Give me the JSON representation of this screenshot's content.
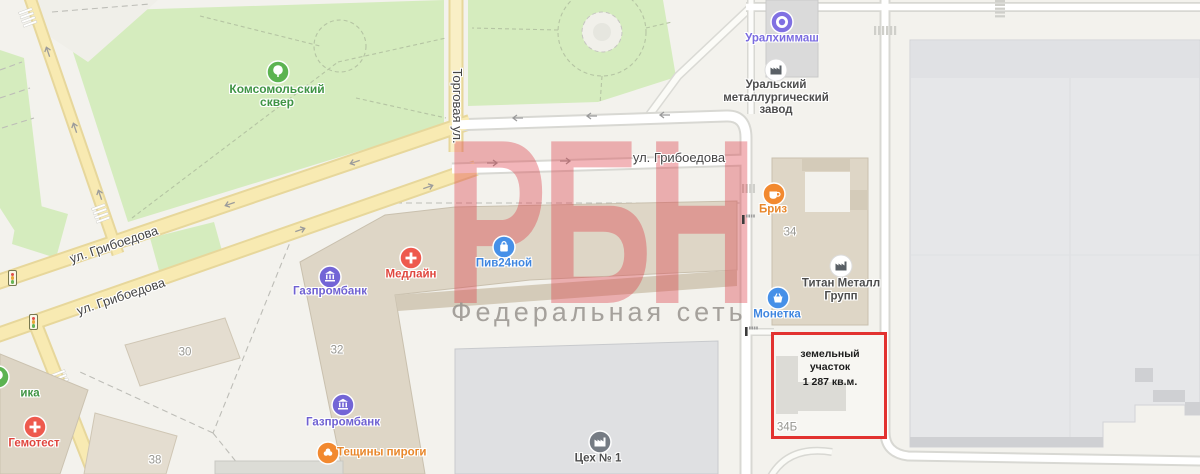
{
  "watermark": {
    "title": "РБН",
    "subtitle": "Федеральная сеть"
  },
  "annotation": {
    "line1": "земельный участок",
    "line2": "1 287 кв.м."
  },
  "streets": {
    "torgovaya": "Торговая ул.",
    "griboedova_diag_upper": "ул. Грибоедова",
    "griboedova_diag_lower": "ул. Грибоедова",
    "griboedova_horizontal": "ул. Грибоедова"
  },
  "parks": {
    "komsomolsky_line1": "Комсомольский",
    "komsomolsky_line2": "сквер"
  },
  "pois": {
    "uralhimmash": {
      "label": "Уралхиммаш"
    },
    "ural_plant": {
      "line1": "Уральский",
      "line2": "металлургический",
      "line3": "завод"
    },
    "briz": {
      "label": "Бриз"
    },
    "titan": {
      "line1": "Титан Металл",
      "line2": "Групп"
    },
    "monetka": {
      "label": "Монетка"
    },
    "piv24": {
      "label": "Пив24ной"
    },
    "medline": {
      "label": "Медлайн"
    },
    "gazprombank_north": {
      "label": "Газпромбанк"
    },
    "gazprombank_south": {
      "label": "Газпромбанк"
    },
    "teshiny_pirogi": {
      "label": "Тещины пироги"
    },
    "gemotest": {
      "label": "Гемотест"
    },
    "clinic_partial": {
      "label": "ика"
    },
    "tseh1": {
      "label": "Цех № 1"
    }
  },
  "building_numbers": {
    "b30": "30",
    "b32": "32",
    "b34": "34",
    "b38": "38",
    "b34b": "34Б"
  },
  "colors": {
    "map_background": "#f3f2ed",
    "park_green": "#d5ecbe",
    "road_yellow": "#f8eab2",
    "road_yellow_casing": "#e7d79b",
    "road_white": "#ffffff",
    "road_casing": "#d8d8d3",
    "building_tan": "#ded6c6",
    "building_gray": "#e6e7e9",
    "annotation_red": "#e23230",
    "watermark_pink": "rgba(222,60,70,0.38)",
    "poi_red": "#ee5a4e",
    "poi_blue": "#4690e8",
    "poi_indigo": "#7365d6",
    "poi_purple": "#8070e2",
    "poi_orange": "#f2892f",
    "poi_green": "#5cb351"
  }
}
